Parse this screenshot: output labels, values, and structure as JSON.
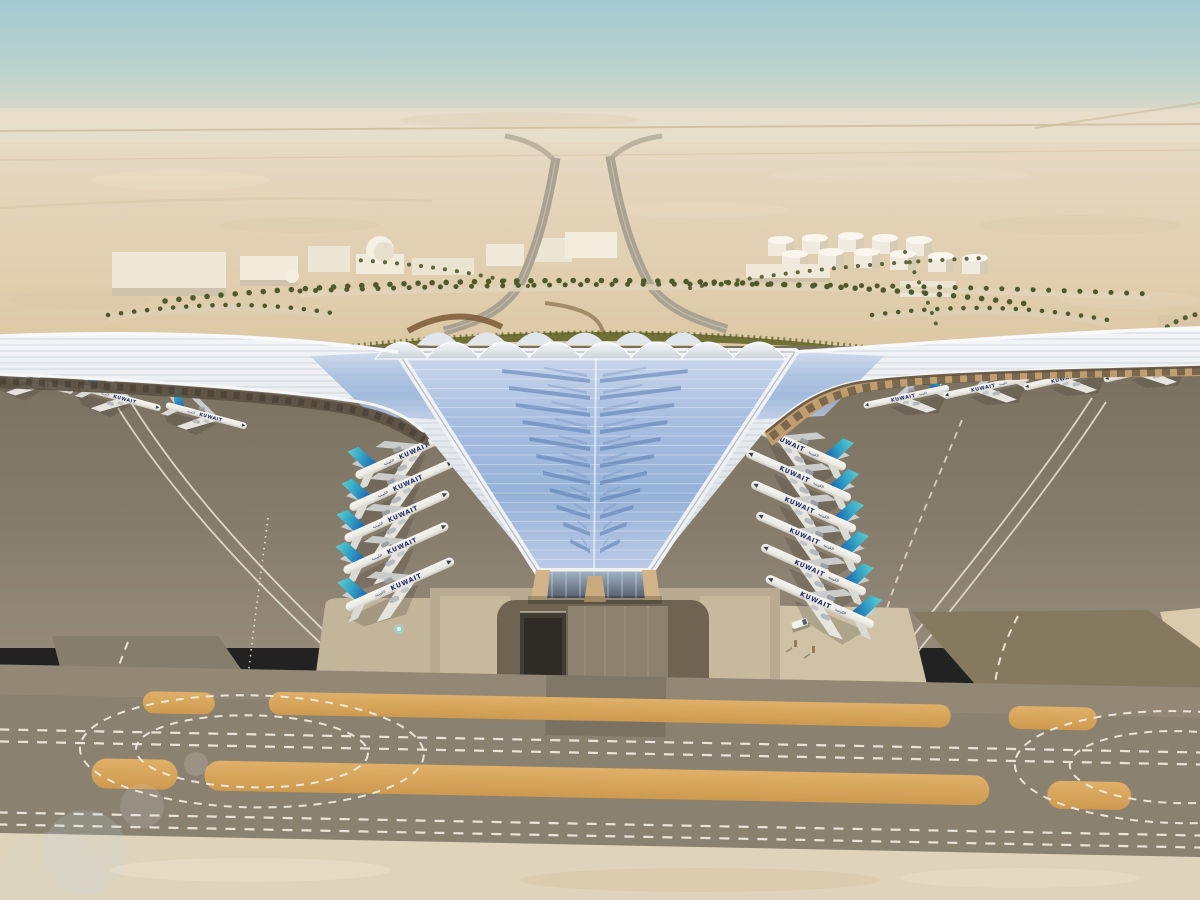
{
  "scene": {
    "title": "Aerial rendering of Kuwait International Airport new passenger terminal in the desert",
    "environment": {
      "setting": "flat desert under hazy teal sky",
      "time_of_day": "day"
    },
    "aircraft_livery": {
      "title_latin": "KUWAIT",
      "title_arabic": "الكويتية",
      "tail_style": "aqua-to-blue gradient fin"
    },
    "aircraft_counts": {
      "left_far_row": 4,
      "left_inner_row": 5,
      "right_inner_row": 6,
      "right_far_row": 4,
      "total_visible": 19
    },
    "terminal": {
      "roof": "white trefoil shell roof with blue photovoltaic panel chevrons",
      "center_roof_bays": 8,
      "facade": "tan arched glazing beneath the eaves"
    },
    "ground_features": [
      "dark aircraft apron with curved white guide lines",
      "parallel taxiway band with dashed white centerlines",
      "orange unpaved sand strips",
      "turning loops marked with dashed circles",
      "sunken service road beneath the forecourt"
    ],
    "background_features": [
      "white warehouses and domed buildings",
      "white fuel storage tanks",
      "palm-lined approach roads",
      "green landscaped belt behind the terminal",
      "twin approach highways"
    ],
    "vehicles_visible": 1,
    "colors": {
      "sky_top": "#a3cad0",
      "sky_haze": "#e4dcc8",
      "desert": "#e2d2b6",
      "roof_white": "#eef1f4",
      "solar_panel_blue": "#9cb8dc",
      "solar_streak": "#4e74ac",
      "apron": "#80776a",
      "taxiway_band": "#8b8170",
      "marking_white": "#f2eee2",
      "unpaved_strip": "#d8a55c",
      "tail_aqua": "#4cc4c8",
      "tail_blue": "#1b5ea8",
      "title_navy": "#232f66",
      "hedge_green": "#6f7136",
      "facade_tan": "#c3a074"
    }
  }
}
